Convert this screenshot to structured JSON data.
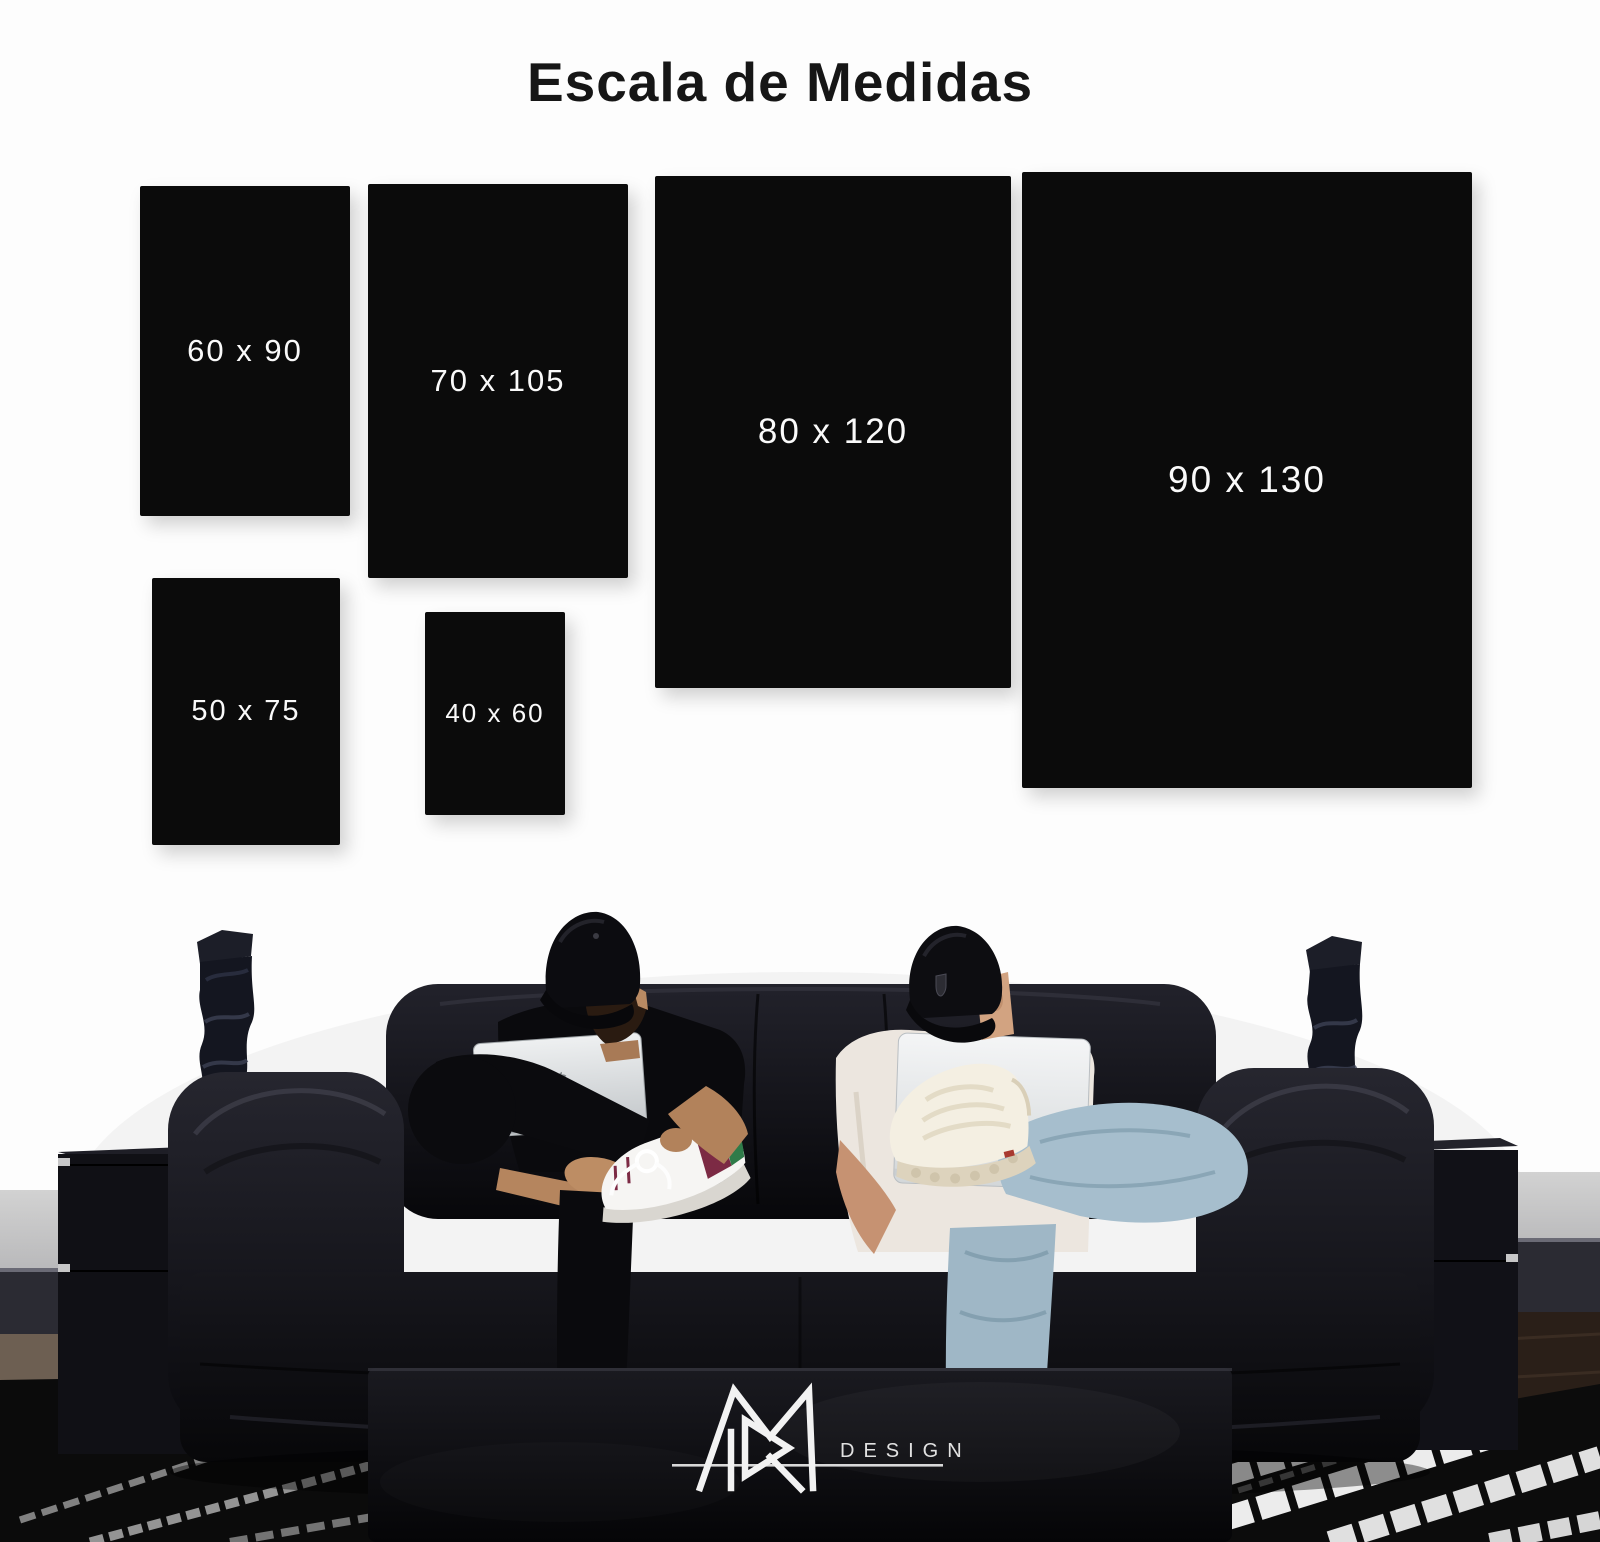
{
  "title": "Escala de Medidas",
  "panels": [
    {
      "label": "60 x 90",
      "width_cm": 60,
      "height_cm": 90
    },
    {
      "label": "70 x 105",
      "width_cm": 70,
      "height_cm": 105
    },
    {
      "label": "80 x 120",
      "width_cm": 80,
      "height_cm": 120
    },
    {
      "label": "90 x 130",
      "width_cm": 90,
      "height_cm": 130
    },
    {
      "label": "50 x 75",
      "width_cm": 50,
      "height_cm": 75
    },
    {
      "label": "40 x 60",
      "width_cm": 40,
      "height_cm": 60
    }
  ],
  "brand": {
    "wordmark": "DESIGN",
    "monogram": "rm-monogram"
  },
  "colors": {
    "background": "#fdfdfd",
    "panel": "#0b0b0b",
    "panel_text": "#fafafa",
    "title_text": "#161616",
    "logo_white": "#f2f2f2"
  }
}
